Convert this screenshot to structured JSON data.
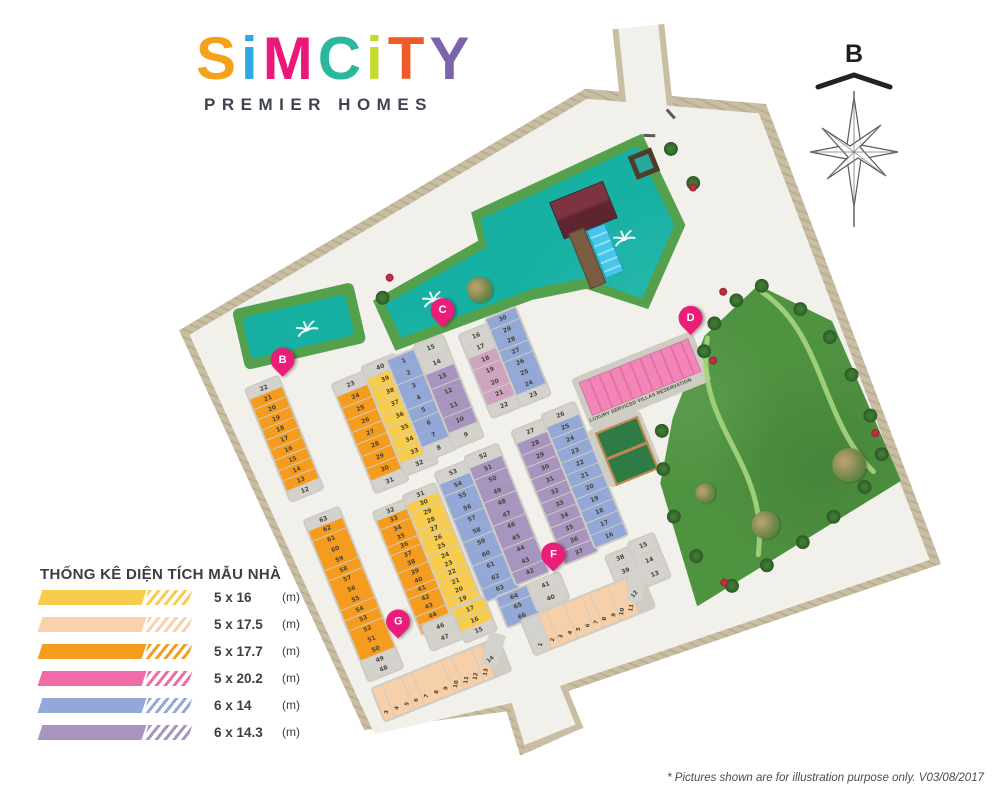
{
  "logo": {
    "letters": [
      {
        "ch": "S",
        "color": "#F5A21B"
      },
      {
        "ch": "i",
        "color": "#2BA9E0"
      },
      {
        "ch": "M",
        "color": "#EC1879"
      },
      {
        "ch": "C",
        "color": "#29B79E"
      },
      {
        "ch": "i",
        "color": "#C5D92D"
      },
      {
        "ch": "T",
        "color": "#F05A28"
      },
      {
        "ch": "Y",
        "color": "#7C64AA"
      }
    ],
    "tagline": "PREMIER HOMES"
  },
  "compass": {
    "label": "B"
  },
  "legend": {
    "title": "THỐNG KÊ DIỆN TÍCH MẪU NHÀ",
    "items": [
      {
        "size": "5 x 16",
        "unit": "(m)",
        "color": "#F8CC4C"
      },
      {
        "size": "5 x 17.5",
        "unit": "(m)",
        "color": "#F9D2AC"
      },
      {
        "size": "5 x 17.7",
        "unit": "(m)",
        "color": "#F59B1E"
      },
      {
        "size": "5 x 20.2",
        "unit": "(m)",
        "color": "#F06CA8"
      },
      {
        "size": "6 x 14",
        "unit": "(m)",
        "color": "#93A8D6"
      },
      {
        "size": "6 x 14.3",
        "unit": "(m)",
        "color": "#A795BF"
      }
    ]
  },
  "map": {
    "villas_label": "LUXURY SERVICED VILLAS RESERVATION",
    "markers": [
      {
        "id": "B"
      },
      {
        "id": "C"
      },
      {
        "id": "D"
      },
      {
        "id": "F"
      },
      {
        "id": "G"
      }
    ],
    "colors": {
      "g": "#D4D2CC",
      "o": "#F59B1E",
      "y": "#F8CC4C",
      "e": "#F7CFA8",
      "b": "#93A8D6",
      "p": "#A795BF",
      "k": "#CDA3BF",
      "road": "#F2F0EA",
      "edge": "#C9BEA3",
      "pool": "#16B1A3",
      "poolrim": "#55A04C",
      "park": "#4E9340",
      "villa": "#F287B7",
      "marker": "#EA1D78"
    },
    "blocks": {
      "b1": [
        "22:g",
        "21:o",
        "20:o",
        "19:o",
        "18:o",
        "17:o",
        "16:o",
        "15:o",
        "14:o",
        "13:o",
        "12:g"
      ],
      "b2L": [
        "23:g",
        "24:o",
        "25:o",
        "26:o",
        "27:o",
        "28:o",
        "29:o",
        "30:o",
        "31:g"
      ],
      "b2R": [
        "40:g",
        "39:y",
        "38:y",
        "37:y",
        "36:y",
        "35:y",
        "34:y",
        "33:y",
        "32:g"
      ],
      "c1L": [
        "1:b",
        "2:b",
        "3:b",
        "4:b",
        "5:b",
        "6:b",
        "7:b",
        "8:g"
      ],
      "c1R": [
        "15:g",
        "14:g",
        "13:p",
        "12:p",
        "11:p",
        "10:p",
        "9:g"
      ],
      "c2L": [
        "16:g",
        "17:g",
        "18:k",
        "19:k",
        "20:k",
        "21:k",
        "22:g"
      ],
      "c2R": [
        "30:b",
        "29:b",
        "28:b",
        "27:b",
        "26:b",
        "25:b",
        "24:b",
        "23:g"
      ],
      "m1": [
        "63:g",
        "62:o",
        "61:o",
        "60:o",
        "59:o",
        "58:o",
        "57:o",
        "56:o",
        "55:o",
        "54:o",
        "53:o",
        "52:o",
        "51:o",
        "50:o",
        "49:g",
        "48:g"
      ],
      "m2L": [
        "32:g",
        "33:o",
        "34:o",
        "35:o",
        "36:o",
        "37:o",
        "38:o",
        "39:o",
        "40:o",
        "41:o",
        "42:o",
        "43:o",
        "44:o",
        "45:o"
      ],
      "m2R": [
        "31:g",
        "30:y",
        "29:y",
        "28:y",
        "27:y",
        "26:y",
        "25:y",
        "24:y",
        "23:y",
        "22:y",
        "21:y",
        "20:y",
        "19:y",
        "18:y"
      ],
      "m2xL": [
        "46:g",
        "47:g"
      ],
      "m2xR": [
        "17:y",
        "16:y",
        "15:g"
      ],
      "m3L": [
        "53:g",
        "54:b",
        "55:b",
        "56:b",
        "57:b",
        "58:b",
        "59:b",
        "60:b",
        "61:b",
        "62:b",
        "63:b"
      ],
      "m3R": [
        "52:g",
        "51:p",
        "50:p",
        "49:p",
        "48:p",
        "47:p",
        "46:p",
        "45:p",
        "44:p",
        "43:p",
        "42:p"
      ],
      "m3xL": [
        "64:b",
        "65:b",
        "66:b"
      ],
      "m3xR": [
        "41:g",
        "40:g"
      ],
      "fL": [
        "27:g",
        "28:p",
        "29:p",
        "30:p",
        "31:p",
        "32:p",
        "33:p",
        "34:p",
        "35:p",
        "36:p",
        "37:p"
      ],
      "fR": [
        "26:g",
        "25:b",
        "24:b",
        "23:b",
        "22:b",
        "21:b",
        "20:b",
        "19:b",
        "18:b",
        "17:b",
        "16:b"
      ],
      "fxL": [
        "38:g",
        "39:g"
      ],
      "fxR": [
        "15:g",
        "14:g",
        "13:g"
      ],
      "gRow": [
        "3:e",
        "4:e",
        "5:e",
        "6:e",
        "7:e",
        "8:e",
        "9:e",
        "10:e",
        "11:e",
        "12:e",
        "13:e",
        "14:g"
      ],
      "fRow": [
        "1:g",
        "2:e",
        "3:e",
        "4:e",
        "5:e",
        "6:e",
        "7:e",
        "8:e",
        "9:e",
        "10:e",
        "11:e",
        "12:g"
      ]
    }
  },
  "footnote": "* Pictures shown are for illustration purpose only. V03/08/2017"
}
